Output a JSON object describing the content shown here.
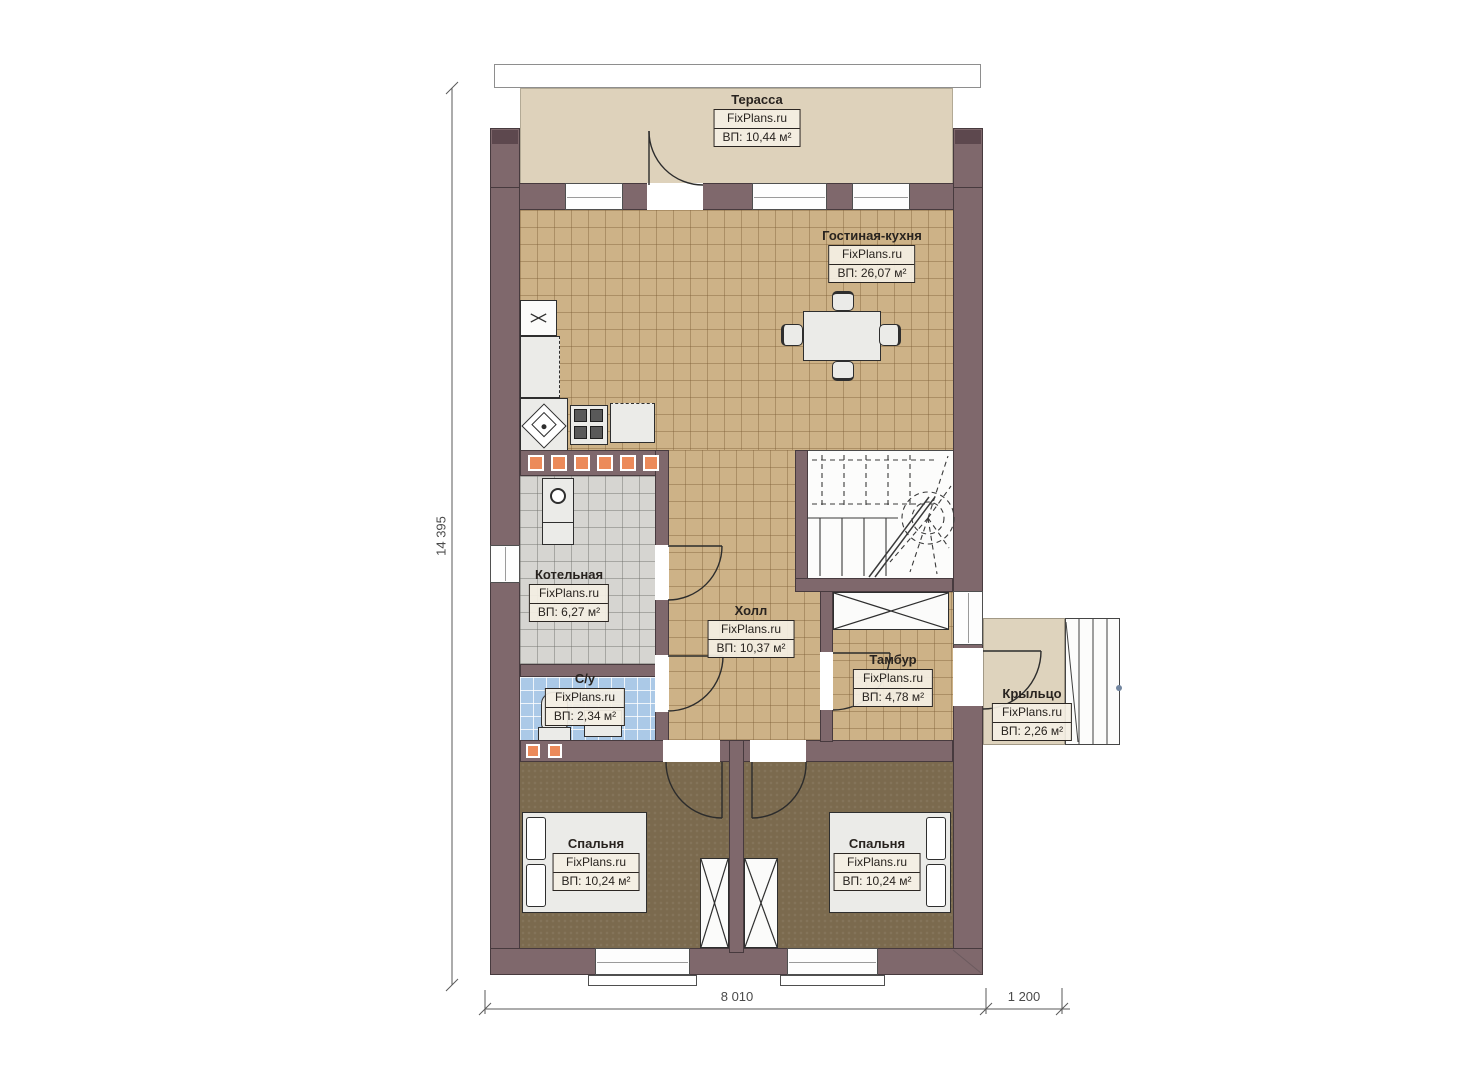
{
  "rooms": {
    "terrace": {
      "name": "Терасса",
      "brand": "FixPlans.ru",
      "area": "ВП: 10,44 м²"
    },
    "living": {
      "name": "Гостиная-кухня",
      "brand": "FixPlans.ru",
      "area": "ВП: 26,07 м²"
    },
    "boiler": {
      "name": "Котельная",
      "brand": "FixPlans.ru",
      "area": "ВП: 6,27 м²"
    },
    "hall": {
      "name": "Холл",
      "brand": "FixPlans.ru",
      "area": "ВП: 10,37 м²"
    },
    "wc": {
      "name": "С/у",
      "brand": "FixPlans.ru",
      "area": "ВП: 2,34 м²"
    },
    "tambur": {
      "name": "Тамбур",
      "brand": "FixPlans.ru",
      "area": "ВП: 4,78 м²"
    },
    "porch": {
      "name": "Крыльцо",
      "brand": "FixPlans.ru",
      "area": "ВП: 2,26 м²"
    },
    "bedroom1": {
      "name": "Спальня",
      "brand": "FixPlans.ru",
      "area": "ВП: 10,24 м²"
    },
    "bedroom2": {
      "name": "Спальня",
      "brand": "FixPlans.ru",
      "area": "ВП: 10,24 м²"
    }
  },
  "dimensions": {
    "height": "14 395",
    "width_main": "8 010",
    "width_porch": "1 200"
  },
  "palette": {
    "wall": "#7f686c",
    "floor_living": "#cdb287",
    "floor_bedroom": "#7b6a4e",
    "floor_boiler": "#d6d5d1",
    "floor_wc": "#abc9e7",
    "floor_terrace": "#ded2bb",
    "accent_orange": "#ec8a5a",
    "line": "#2e2e2e"
  }
}
